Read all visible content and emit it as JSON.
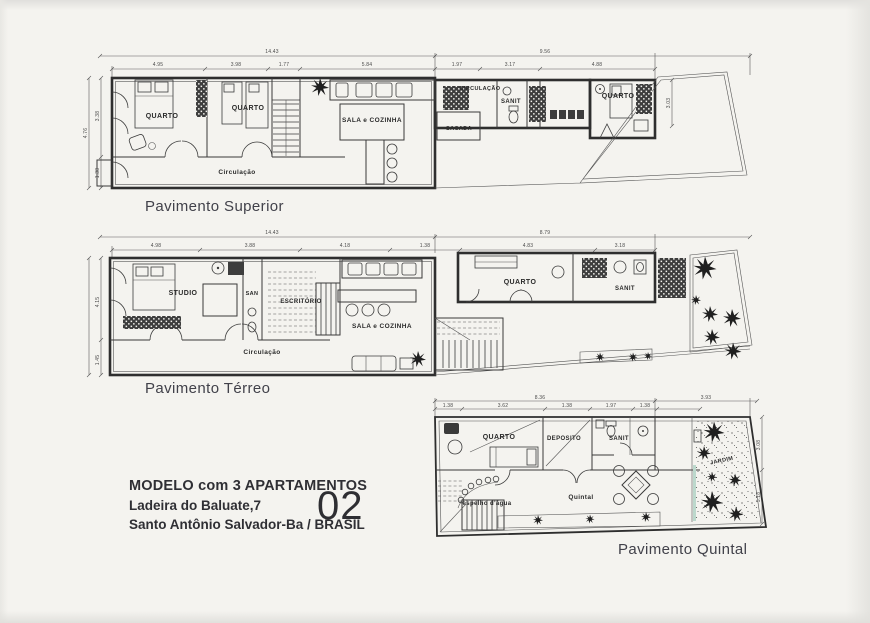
{
  "colors": {
    "ink": "#2e2e2e",
    "paper": "#f4f3ef"
  },
  "captions": {
    "superior": "Pavimento Superior",
    "terreo": "Pavimento Térreo",
    "quintal": "Pavimento Quintal"
  },
  "title_block": {
    "line1": "MODELO com 3 APARTAMENTOS",
    "line2": "Ladeira do Baluate,7",
    "line3": "Santo Antônio Salvador-Ba / BRASIL",
    "number": "02"
  },
  "superior": {
    "rooms": {
      "quarto1": "QUARTO",
      "quarto2": "QUARTO",
      "circulacao": "Circulação",
      "sala": "SALA e COZINHA",
      "circ2": "CIRCULAÇÃO",
      "sacada": "SACADA",
      "sanit": "SANIT",
      "quarto3": "QUARTO"
    },
    "dims": {
      "total": "14.43",
      "rt": "9.56",
      "a": "4.95",
      "b": "3.98",
      "c": "1.77",
      "d": "5.84",
      "r1": "1.97",
      "r2": "3.17",
      "r3": "4.88",
      "v0": "4.76",
      "v1": "3.38",
      "v2": "1.38",
      "v3": "3.03"
    }
  },
  "terreo": {
    "rooms": {
      "studio": "STUDIO",
      "san": "SAN",
      "escritorio": "ESCRITÓRIO",
      "sala": "SALA e COZINHA",
      "circulacao": "Circulação",
      "quarto": "QUARTO",
      "sanit": "SANIT"
    },
    "dims": {
      "total": "14.43",
      "rt": "8.79",
      "a": "4.98",
      "b": "3.88",
      "c": "4.18",
      "d": "1.38",
      "e": "4.83",
      "f": "3.18",
      "v1": "4.15",
      "v2": "1.45"
    }
  },
  "quintal": {
    "rooms": {
      "quarto": "QUARTO",
      "deposito": "DEPOSITO",
      "sanit": "SANIT",
      "jardim": "JARDIM",
      "quintal": "Quintal",
      "espelho": "espelho d'água"
    },
    "dims": {
      "t1": "8.36",
      "t2": "3.93",
      "a": "1.38",
      "b": "3.62",
      "c": "1.38",
      "d": "1.97",
      "e": "1.38",
      "v1": "3.08",
      "v2": "5.18"
    }
  }
}
